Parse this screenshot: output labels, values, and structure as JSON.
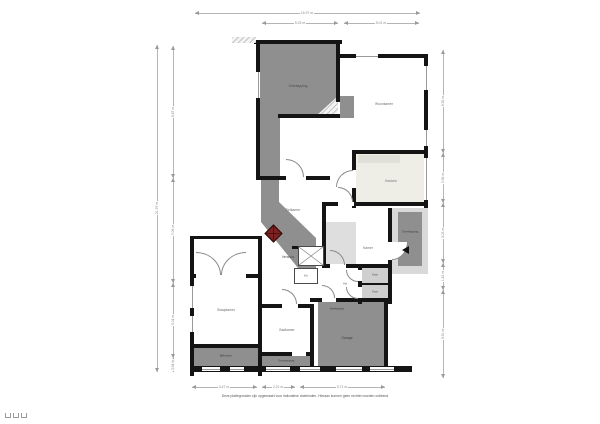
{
  "plan": {
    "rooms": {
      "overkapping_top": {
        "label": "Overkapping"
      },
      "woonkamer": {
        "label": "Woonkamer"
      },
      "keuken": {
        "label": "Keuken"
      },
      "eetkamer": {
        "label": "Eetkamer"
      },
      "veranda": {
        "label": "Veranda"
      },
      "kamer": {
        "label": "Kamer"
      },
      "overkapping_right": {
        "label": "Overkapping"
      },
      "hal": {
        "label": "Hal"
      },
      "kast_1": {
        "label": "Kast"
      },
      "kast_2": {
        "label": "Kast"
      },
      "wc": {
        "label": "Wc"
      },
      "slaapkamer": {
        "label": "Slaapkamer"
      },
      "badkamer": {
        "label": "Badkamer"
      },
      "bijkeuken": {
        "label": "Bijkeuken"
      },
      "overkapping_bottom": {
        "label": "Overkapping"
      },
      "werkplaats": {
        "label": "Werkplaats"
      },
      "garage": {
        "label": "Garage"
      }
    },
    "dimensions": {
      "top_total": "15.97 m",
      "top_segments": [
        "5.23 m",
        "5.01 m"
      ],
      "left_total": "21.97 m",
      "left_segments": [
        "8.87 m",
        "7.06 m",
        "5.04 m",
        "0.94 m"
      ],
      "right_segments": [
        "6.92 m",
        "3.36 m",
        "4.03 m",
        "1.81 m",
        "5.91 m"
      ],
      "bottom_segments": [
        "4.47 m",
        "2.22 m",
        "5.71 m"
      ]
    },
    "colors": {
      "wall": "#141414",
      "covered_area_gray": "#8f8f8f",
      "light_gray": "#d9d9d9",
      "kitchen_cream": "#efeee6",
      "stove_red": "#7c2020",
      "dimension_line": "#b5b5b5",
      "label_gray": "#6e6e6e"
    },
    "caption": "Deze plattegronden zijn opgemaakt voor indicatieve doeleinden. Hieraan kunnen geen rechten worden ontleend"
  }
}
